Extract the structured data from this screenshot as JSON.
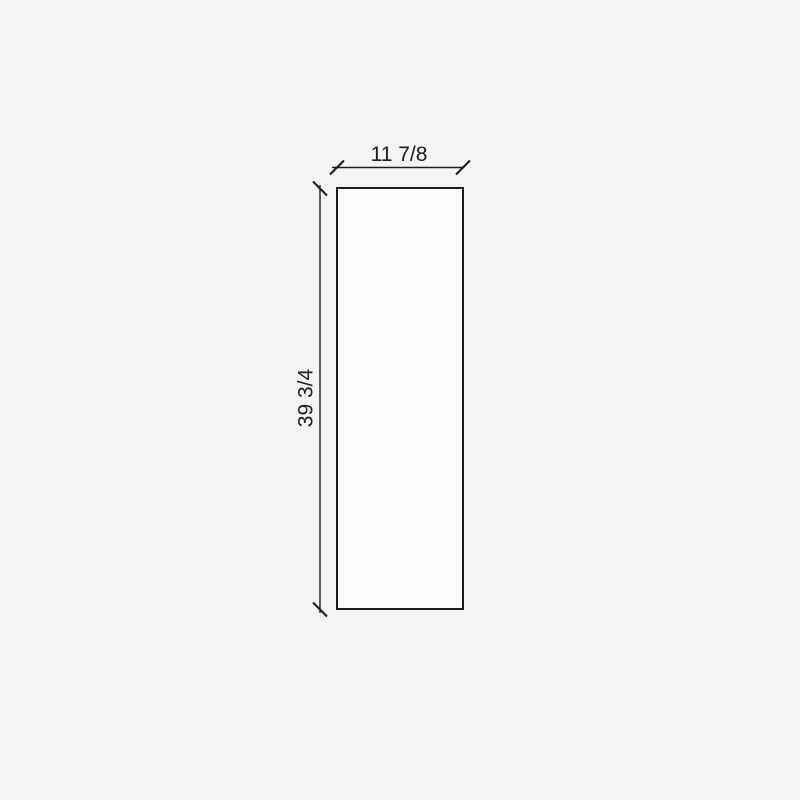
{
  "diagram": {
    "kind": "panel-dimension-drawing",
    "shape": "rectangle",
    "width_label": "11 7/8",
    "height_label": "39 3/4",
    "colors": {
      "background": "#f5f5f4",
      "line": "#1d1d1b",
      "shape_fill": "#fcfcfc"
    }
  }
}
